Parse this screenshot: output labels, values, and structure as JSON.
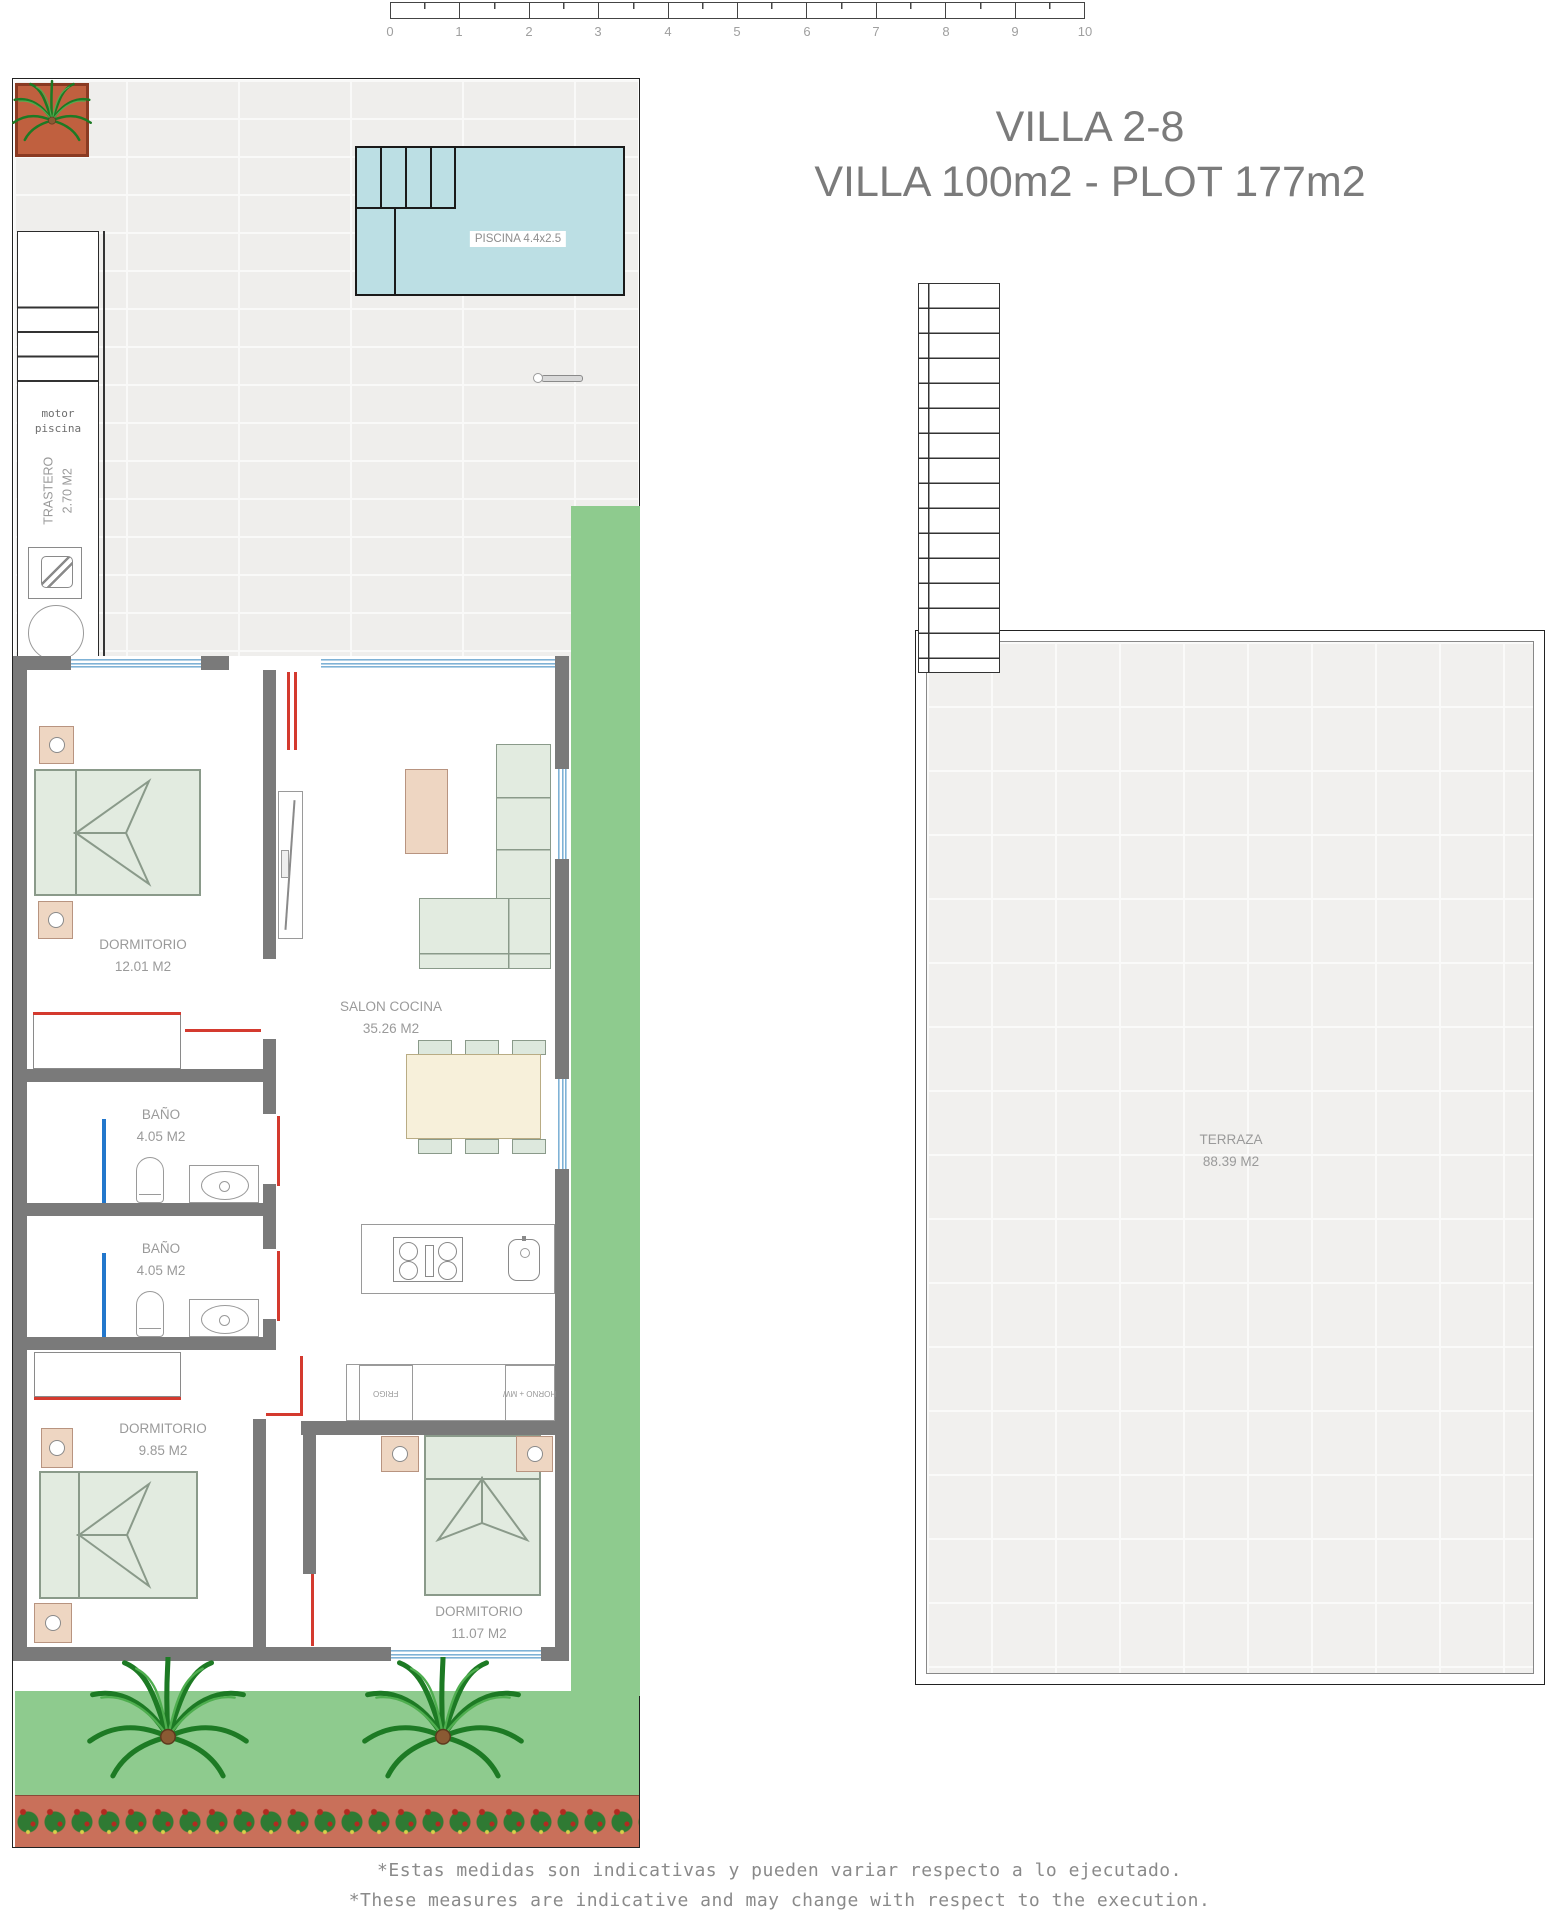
{
  "ruler": {
    "ticks": [
      "0",
      "1",
      "2",
      "3",
      "4",
      "5",
      "6",
      "7",
      "8",
      "9",
      "10"
    ]
  },
  "title": {
    "line1": "VILLA 2-8",
    "line2": "VILLA 100m2 - PLOT 177m2"
  },
  "pool": {
    "label": "PISCINA 4.4x2.5"
  },
  "trastero": {
    "note": "motor\npiscina",
    "name": "TRASTERO",
    "area": "2.70 M2"
  },
  "rooms": {
    "dormitorio1": {
      "name": "DORMITORIO",
      "area": "12.01 M2"
    },
    "salon": {
      "name": "SALON COCINA",
      "area": "35.26 M2"
    },
    "bano1": {
      "name": "BAÑO",
      "area": "4.05 M2"
    },
    "bano2": {
      "name": "BAÑO",
      "area": "4.05 M2"
    },
    "dormitorio2": {
      "name": "DORMITORIO",
      "area": "9.85 M2"
    },
    "dormitorio3": {
      "name": "DORMITORIO",
      "area": "11.07 M2"
    },
    "terraza": {
      "name": "TERRAZA",
      "area": "88.39 M2"
    }
  },
  "kitchen": {
    "fridge_label": "FRIGO",
    "oven_label": "HORNO + MW"
  },
  "footer": {
    "line_es": "*Estas medidas son indicativas y pueden variar respecto a lo ejecutado.",
    "line_en": "*These measures are indicative and may change with respect to the execution."
  },
  "colors": {
    "wall": "#7a7a7a",
    "pool": "#bcdfe4",
    "garden": "#8ecb8e",
    "door": "#d43a2f",
    "window": "#7fb2d6",
    "flowerbed": "#c9705a"
  }
}
